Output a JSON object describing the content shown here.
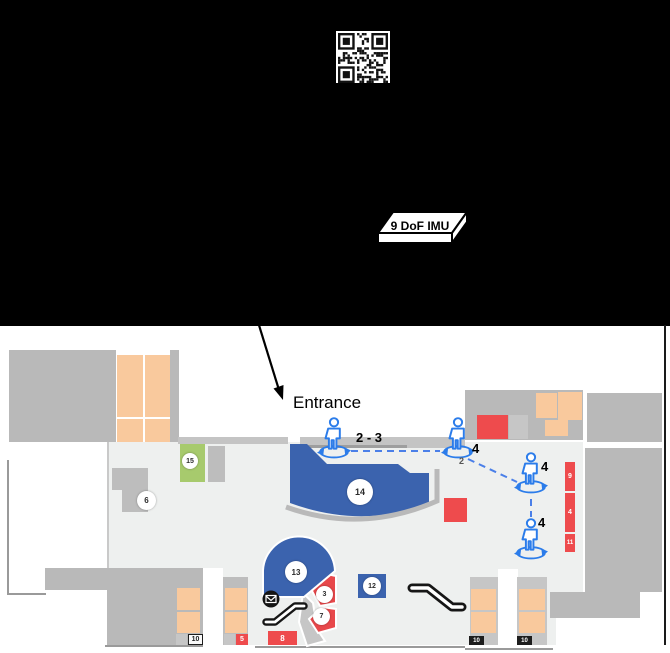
{
  "device": {
    "imu_label": "9 DoF IMU"
  },
  "map": {
    "entrance_label": "Entrance",
    "path_labels": {
      "p1": "2 - 3",
      "p2": "4",
      "p3": "4",
      "p4": "4"
    },
    "rooms": {
      "r15": "15",
      "r6": "6",
      "r14": "14",
      "r13": "13",
      "r3": "3",
      "r7": "7",
      "r12": "12",
      "s9": "9",
      "s4": "4",
      "s11": "11",
      "b5": "5",
      "b8": "8",
      "b10a": "10",
      "b10b": "10",
      "b10c": "10",
      "ghost2": "2"
    },
    "colors": {
      "wall": "#b9b9b9",
      "floor": "#eef0ef",
      "shop": "#f9c99d",
      "accent_blue": "#3b63ae",
      "red": "#ee4b4d",
      "green": "#a7ca6d",
      "person_blue": "#2b7cea",
      "path_blue": "#4a7fe8"
    }
  }
}
